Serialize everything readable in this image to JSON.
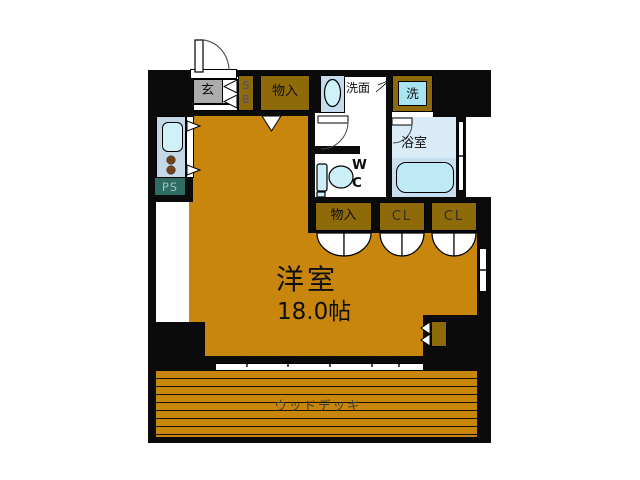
{
  "plan": {
    "title": "1R apartment floor plan",
    "entrance": {
      "label": "玄"
    },
    "shoe_box": {
      "top": "S",
      "bottom": "B"
    },
    "hall_storage": {
      "label": "物入"
    },
    "washstand": {
      "label": "洗面"
    },
    "laundry": {
      "label": "洗"
    },
    "bathroom": {
      "label": "浴室"
    },
    "toilet": {
      "line1": "W",
      "line2": "C"
    },
    "pipe_space": {
      "label": "PS"
    },
    "lower_storage": {
      "label": "物入"
    },
    "closet_left": {
      "label": "CL"
    },
    "closet_right": {
      "label": "CL"
    },
    "main_room": {
      "name": "洋室",
      "size": "18.0帖"
    },
    "wood_deck": {
      "label": "ウッドデッキ"
    },
    "colors": {
      "wall": "#0b0b0b",
      "room_floor": "#c8860d",
      "closet_brown": "#8f6a08",
      "genkan_gray": "#acacac",
      "fixture_panel": "#c4dcee",
      "fixture_fill": "#cdeff7",
      "bath_floor": "#daebf8",
      "bath_lower": "#c6def0",
      "pipe_space_bg": "#2e6b62",
      "pipe_space_text": "#9cc0b8",
      "shoe_box_text": "#46507e"
    }
  }
}
